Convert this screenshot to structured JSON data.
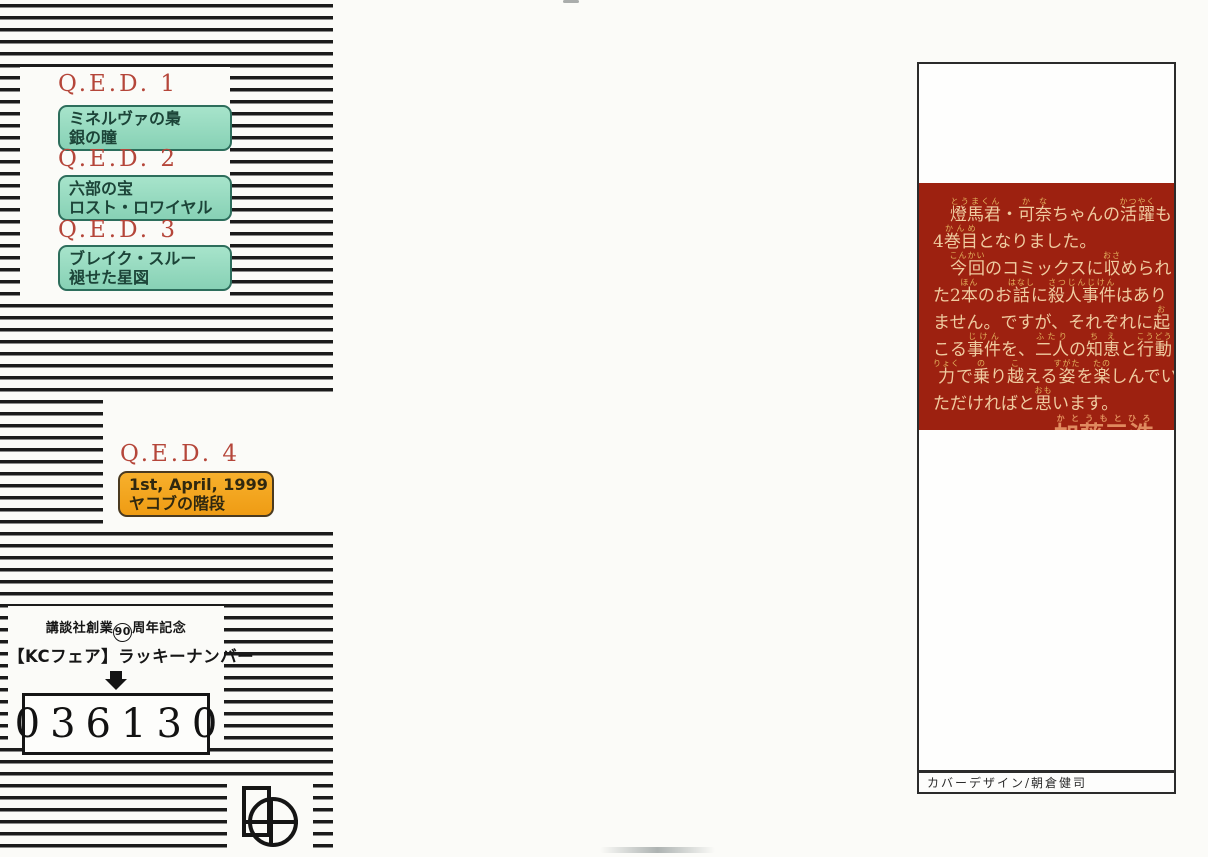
{
  "colors": {
    "stripe_black": "#1b1b1b",
    "qed_title_red": "#b5463a",
    "teal_box_fill": "#97dcc0",
    "teal_box_border": "#2d6e5c",
    "orange_box_fill": "#f3a620",
    "red_panel": "#9d2110",
    "message_text_cream": "#efcba0",
    "furigana_yellow": "#e3b45e",
    "signature_salmon": "#e08a5f"
  },
  "icons": {
    "publisher_mark": "rectangle-circle-cross publisher logo",
    "lucky_arrow": "solid black down arrow"
  },
  "qed": {
    "items": [
      {
        "title": "Q.E.D. 1",
        "line1": "ミネルヴァの梟",
        "line2": "銀の瞳"
      },
      {
        "title": "Q.E.D. 2",
        "line1": "六部の宝",
        "line2": "ロスト・ロワイヤル"
      },
      {
        "title": "Q.E.D. 3",
        "line1": "ブレイク・スルー",
        "line2": "褪せた星図"
      },
      {
        "title": "Q.E.D. 4",
        "line1": "1st, April, 1999",
        "line2": "ヤコブの階段"
      }
    ]
  },
  "lucky": {
    "anniversary_pre": "講談社創業",
    "anniversary_circled": "90",
    "anniversary_post": "周年記念",
    "fair_label": "【KCフェア】ラッキーナンバー",
    "number": "036130"
  },
  "message": {
    "lines": [
      [
        {
          "t": "　"
        },
        {
          "t": "燈馬君",
          "r": "とうまくん"
        },
        {
          "t": "・"
        },
        {
          "t": "可奈",
          "r": "かな"
        },
        {
          "t": "ちゃんの"
        },
        {
          "t": "活躍",
          "r": "かつやく"
        },
        {
          "t": "も"
        }
      ],
      [
        {
          "t": "4"
        },
        {
          "t": "巻目",
          "r": "かんめ"
        },
        {
          "t": "となりました。"
        }
      ],
      [
        {
          "t": "　"
        },
        {
          "t": "今回",
          "r": "こんかい"
        },
        {
          "t": "のコミックスに"
        },
        {
          "t": "収",
          "r": "おさ"
        },
        {
          "t": "められ"
        }
      ],
      [
        {
          "t": "た2"
        },
        {
          "t": "本",
          "r": "ほん"
        },
        {
          "t": "のお"
        },
        {
          "t": "話",
          "r": "はなし"
        },
        {
          "t": "に"
        },
        {
          "t": "殺人事件",
          "r": "さつじんじけん"
        },
        {
          "t": "はあり"
        }
      ],
      [
        {
          "t": "ません。ですが、それぞれに"
        },
        {
          "t": "起",
          "r": "お"
        }
      ],
      [
        {
          "t": "こる"
        },
        {
          "t": "事件",
          "r": "じけん"
        },
        {
          "t": "を、"
        },
        {
          "t": "二人",
          "r": "ふたり"
        },
        {
          "t": "の"
        },
        {
          "t": "知恵",
          "r": "ちえ"
        },
        {
          "t": "と"
        },
        {
          "t": "行動",
          "r": "こうどう"
        }
      ],
      [
        {
          "t": "力",
          "r": "りょく"
        },
        {
          "t": "で"
        },
        {
          "t": "乗",
          "r": "の"
        },
        {
          "t": "り"
        },
        {
          "t": "越",
          "r": "こ"
        },
        {
          "t": "える"
        },
        {
          "t": "姿",
          "r": "すがた"
        },
        {
          "t": "を"
        },
        {
          "t": "楽",
          "r": "たの"
        },
        {
          "t": "しんでい"
        }
      ],
      [
        {
          "t": "ただければと"
        },
        {
          "t": "思",
          "r": "おも"
        },
        {
          "t": "います。"
        }
      ]
    ],
    "signature": "加藤元浩",
    "signature_ruby": "かとうもとひろ"
  },
  "footer": {
    "credit": "カバーデザイン/朝倉健司"
  }
}
